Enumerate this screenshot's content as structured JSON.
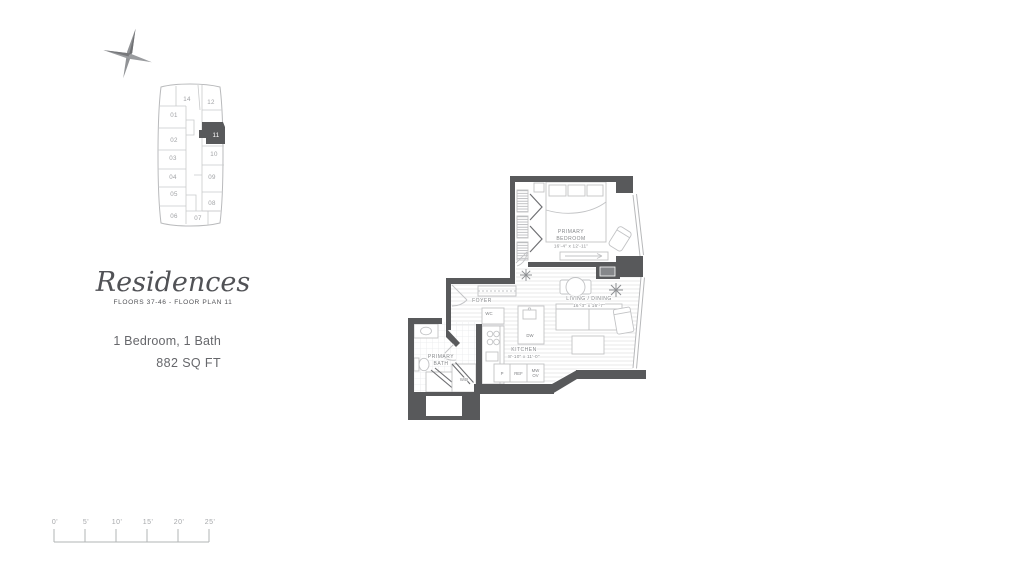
{
  "brand": {
    "title": "Residences",
    "subtitle": "FLOORS 37-46 - FLOOR PLAN 11",
    "configuration": "1 Bedroom, 1 Bath",
    "area": "882 SQ FT"
  },
  "keyplan": {
    "highlighted_unit": "11",
    "units": [
      {
        "label": "01"
      },
      {
        "label": "02"
      },
      {
        "label": "03"
      },
      {
        "label": "04"
      },
      {
        "label": "05"
      },
      {
        "label": "06"
      },
      {
        "label": "07"
      },
      {
        "label": "08"
      },
      {
        "label": "09"
      },
      {
        "label": "10"
      },
      {
        "label": "11"
      },
      {
        "label": "12"
      },
      {
        "label": "14"
      }
    ]
  },
  "plan": {
    "rooms": {
      "primary_bedroom": {
        "name_line1": "PRIMARY",
        "name_line2": "BEDROOM",
        "dims": "16'-4\" x 12'-11\""
      },
      "living_dining": {
        "name": "LIVING / DINING",
        "dims": "16'-3\" x 16'-7\""
      },
      "foyer": {
        "name": "FOYER"
      },
      "kitchen": {
        "name": "KITCHEN",
        "dims": "8'-10\" x 11'-0\""
      },
      "primary_bath": {
        "name_line1": "PRIMARY",
        "name_line2": "BATH"
      }
    },
    "fixtures": {
      "wc": "WC",
      "washer_dryer": "W/D",
      "dishwasher": "DW",
      "pantry": "P",
      "refrigerator": "REF",
      "microwave_line1": "MW",
      "microwave_line2": "OV"
    }
  },
  "scalebar": {
    "labels": [
      "0'",
      "5'",
      "10'",
      "15'",
      "20'",
      "25'"
    ]
  },
  "colors": {
    "wall": "#58595b",
    "furniture_line": "#c2c3c5",
    "label_text": "#85878a",
    "floor_stripe": "#e6e7e8"
  }
}
